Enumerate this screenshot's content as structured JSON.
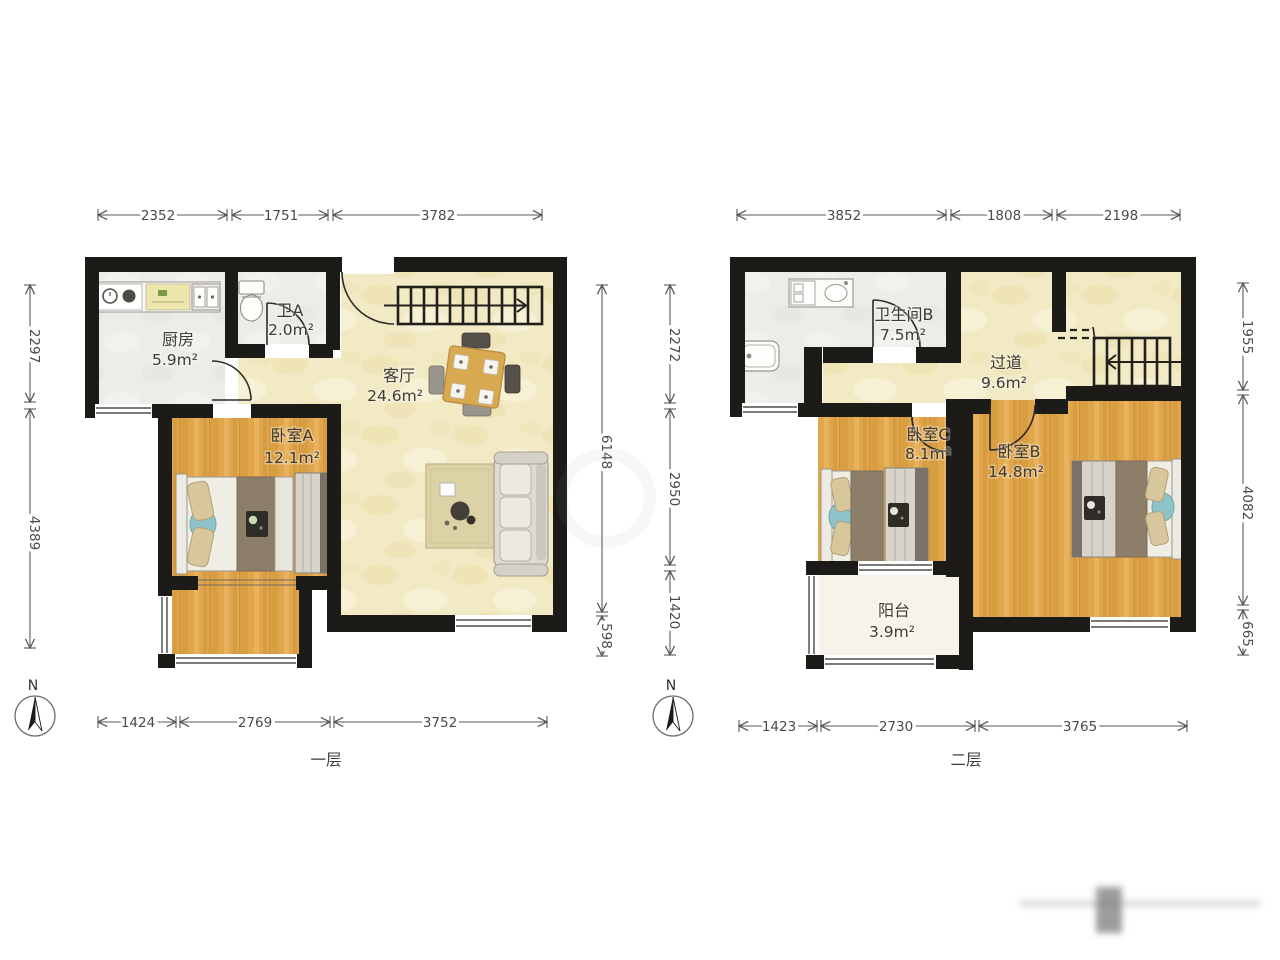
{
  "floor1": {
    "label": "一层",
    "compass": "N",
    "dims": {
      "top": [
        "2352",
        "1751",
        "3782"
      ],
      "left": [
        "2297",
        "4389"
      ],
      "right": [
        "6148",
        "598"
      ],
      "bottom": [
        "1424",
        "2769",
        "3752"
      ]
    },
    "rooms": {
      "kitchen": {
        "name": "厨房",
        "area": "5.9m²"
      },
      "bath_a": {
        "name": "卫A",
        "area": "2.0m²"
      },
      "living": {
        "name": "客厅",
        "area": "24.6m²"
      },
      "bedroom_a": {
        "name": "卧室A",
        "area": "12.1m²"
      }
    }
  },
  "floor2": {
    "label": "二层",
    "compass": "N",
    "dims": {
      "top": [
        "3852",
        "1808",
        "2198"
      ],
      "left": [
        "2272",
        "2950",
        "1420"
      ],
      "right": [
        "1955",
        "4082",
        "665"
      ],
      "bottom": [
        "1423",
        "2730",
        "3765"
      ]
    },
    "rooms": {
      "bath_b": {
        "name": "卫生间B",
        "area": "7.5m²"
      },
      "hallway": {
        "name": "过道",
        "area": "9.6m²"
      },
      "bedroom_c": {
        "name": "卧室C",
        "area": "8.1m²"
      },
      "bedroom_b": {
        "name": "卧室B",
        "area": "14.8m²"
      },
      "balcony": {
        "name": "阳台",
        "area": "3.9m²"
      }
    }
  },
  "colors": {
    "wall": "#1d1b18",
    "floor_wood": "#e0a64c",
    "floor_yellow": "#f2e9c5",
    "floor_gray": "#ecece9",
    "balcony": "#f6f3ea",
    "teal_accent": "#8ec3c9",
    "blanket_brown": "#8d7e69"
  }
}
